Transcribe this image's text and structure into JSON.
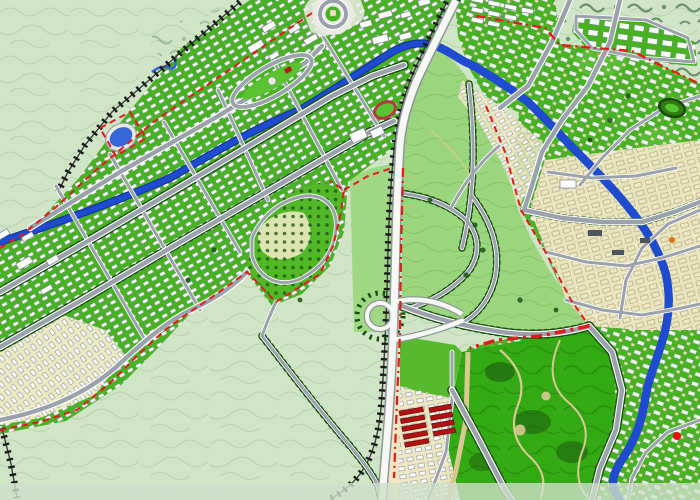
{
  "meta": {
    "type": "urban-master-plan-map",
    "description": "Colored urban master plan: a linear new town running diagonally from lower-left to upper-center, an existing city on the right bank of a blue river, a large central park, a north-south freeway bypass with a loop interchange, hatched railway lines, and red dashed planning boundaries over pale-green scrubland with contour lines.",
    "visible_text": []
  },
  "palette": {
    "bg": "#cfe5c6",
    "contour": "#b4d0a9",
    "scrub": "#527e52",
    "parkMedium": "#9bd67e",
    "parkMediumTex": "#82c465",
    "parkBright": "#33a913",
    "parkBrightTex": "#2a8f0e",
    "urbanGreen": "#45b41e",
    "urbanGreenLight": "#5ac332",
    "hillGreen": "#52b827",
    "cream": "#ebeac2",
    "road": "#9ba2ab",
    "roadCasing": "#ffffff",
    "freeway": "#f7f8f4",
    "freewayCasing": "#8f969d",
    "river": "#1e4bcf",
    "riverCasing": "#15379b",
    "lake": "#3767d6",
    "rail": "#1c1c1c",
    "railBase": "#3c3c3c",
    "boundary": "#e41b1b",
    "buildingWhite": "#ffffff",
    "buildingStroke": "#79828e",
    "buildingTan": "#eee7c3",
    "buildingTanStroke": "#9a9170",
    "buildingRed": "#b11313",
    "buildingDark": "#4c545c",
    "plaza": "#e9ebe2",
    "pathTan": "#d9c891",
    "treeDark": "#1a5410",
    "treeDot": "#17500e",
    "trackRed": "#b23b3b",
    "markerRed": "#e31111",
    "markerOrange": "#e0720f",
    "bottomBand": "#cfe0ca"
  },
  "features": {
    "terrain": [
      "undeveloped-scrubland",
      "contour-lines",
      "hill-shrub-marks"
    ],
    "hydrology": [
      "main-river",
      "ornamental-lake",
      "upland-creek"
    ],
    "transport": [
      "freeway-bypass",
      "loop-interchange",
      "railway-northwest",
      "railway-central",
      "railway-south",
      "arterial-road-grid",
      "roundabout-plaza",
      "central-mall-ring-road",
      "tree-lined-avenues"
    ],
    "districts": [
      "linear-new-town",
      "hillside-low-density-quarter",
      "old-town-core",
      "riverside-quarter",
      "north-terrace-rows",
      "warehouse-rows-red",
      "south-housing-rows",
      "southwest-cream-quarter"
    ],
    "parks": [
      "central-park",
      "south-park",
      "athletics-track",
      "mini-stadium"
    ],
    "boundaries": [
      "planning-boundary-red-dashed",
      "planning-boundary-dash-dot"
    ]
  }
}
